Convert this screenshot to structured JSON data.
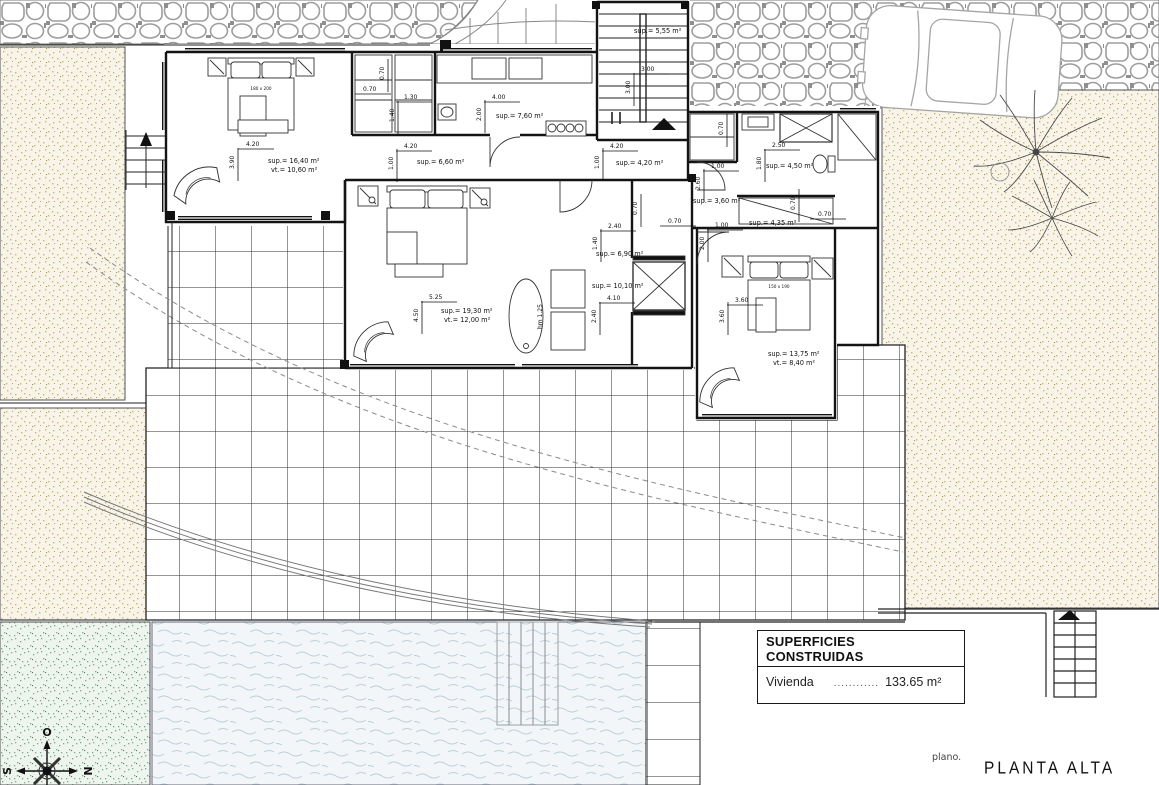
{
  "titles": {
    "plano_label": "plano.",
    "plan_title": "PLANTA ALTA"
  },
  "areas_table": {
    "header": "SUPERFICIES CONSTRUIDAS",
    "row": {
      "label": "Vivienda",
      "dots": "............",
      "value": "133.65 m²"
    }
  },
  "compass": {
    "top": "O",
    "left": "S",
    "right": "N"
  },
  "room_labels": [
    {
      "text": "sup.= 16,40 m²",
      "x": 268,
      "y": 163
    },
    {
      "text": "vt.= 10,60 m²",
      "x": 271,
      "y": 172
    },
    {
      "text": "sup.= 6,60 m²",
      "x": 417,
      "y": 164
    },
    {
      "text": "sup.= 7,60 m²",
      "x": 496,
      "y": 118
    },
    {
      "text": "sup.= 5,55 m²",
      "x": 634,
      "y": 33
    },
    {
      "text": "sup.= 4,20 m²",
      "x": 616,
      "y": 165
    },
    {
      "text": "sup.= 4,50 m²",
      "x": 766,
      "y": 168
    },
    {
      "text": "sup.= 3,60 m²",
      "x": 693,
      "y": 203
    },
    {
      "text": "sup.= 4,35 m²",
      "x": 749,
      "y": 225
    },
    {
      "text": "sup.= 6,90 m²",
      "x": 596,
      "y": 256
    },
    {
      "text": "sup.= 10,10 m²",
      "x": 592,
      "y": 288
    },
    {
      "text": "sup.= 19,30 m²",
      "x": 441,
      "y": 313
    },
    {
      "text": "vt.= 12,00 m²",
      "x": 444,
      "y": 322
    },
    {
      "text": "sup.= 13,75 m²",
      "x": 768,
      "y": 356
    },
    {
      "text": "vt.= 8,40 m²",
      "x": 773,
      "y": 365
    }
  ],
  "dims_h": [
    {
      "text": "4.20",
      "x": 246,
      "y": 146
    },
    {
      "text": "0.70",
      "x": 363,
      "y": 91
    },
    {
      "text": "1.30",
      "x": 404,
      "y": 99
    },
    {
      "text": "4.20",
      "x": 404,
      "y": 148
    },
    {
      "text": "4.00",
      "x": 492,
      "y": 99
    },
    {
      "text": "3.00",
      "x": 641,
      "y": 71
    },
    {
      "text": "4.20",
      "x": 610,
      "y": 148
    },
    {
      "text": "2.50",
      "x": 772,
      "y": 147
    },
    {
      "text": "1.00",
      "x": 711,
      "y": 168
    },
    {
      "text": "0.70",
      "x": 818,
      "y": 216
    },
    {
      "text": "1.00",
      "x": 715,
      "y": 227
    },
    {
      "text": "2.40",
      "x": 608,
      "y": 228
    },
    {
      "text": "0.70",
      "x": 668,
      "y": 223
    },
    {
      "text": "4.10",
      "x": 607,
      "y": 300
    },
    {
      "text": "5.25",
      "x": 429,
      "y": 299
    },
    {
      "text": "3.60",
      "x": 735,
      "y": 302
    }
  ],
  "dims_v": [
    {
      "text": "3.90",
      "x": 234,
      "y": 157
    },
    {
      "text": "1.40",
      "x": 394,
      "y": 110
    },
    {
      "text": "0.70",
      "x": 384,
      "y": 68
    },
    {
      "text": "1.00",
      "x": 393,
      "y": 158
    },
    {
      "text": "2.00",
      "x": 481,
      "y": 109
    },
    {
      "text": "3.00",
      "x": 630,
      "y": 82
    },
    {
      "text": "1.00",
      "x": 599,
      "y": 157
    },
    {
      "text": "0.70",
      "x": 723,
      "y": 123
    },
    {
      "text": "1.80",
      "x": 761,
      "y": 158
    },
    {
      "text": "2.60",
      "x": 700,
      "y": 178
    },
    {
      "text": "0.70",
      "x": 795,
      "y": 198
    },
    {
      "text": "2.00",
      "x": 704,
      "y": 238
    },
    {
      "text": "1.40",
      "x": 597,
      "y": 238
    },
    {
      "text": "0.70",
      "x": 637,
      "y": 203
    },
    {
      "text": "2.40",
      "x": 596,
      "y": 311
    },
    {
      "text": "4.50",
      "x": 418,
      "y": 310
    },
    {
      "text": "3.60",
      "x": 724,
      "y": 311
    },
    {
      "text": "hm 1.25",
      "x": 542,
      "y": 317,
      "notick": true
    }
  ],
  "bed_labels": [
    {
      "text": "180 x 200",
      "x": 261,
      "y": 90
    },
    {
      "text": "150 x 190",
      "x": 779,
      "y": 288
    }
  ],
  "colors": {
    "line": "#1a1a1a",
    "cobble_stroke": "#9e9e9e",
    "sand_bg": "#f8f4e8",
    "sand_dot": "#c7b687",
    "grass_bg": "#edf5ee",
    "grass_dot": "#82a98c",
    "water_bg": "#f2f6f8",
    "water_wave": "#bcd0da"
  }
}
